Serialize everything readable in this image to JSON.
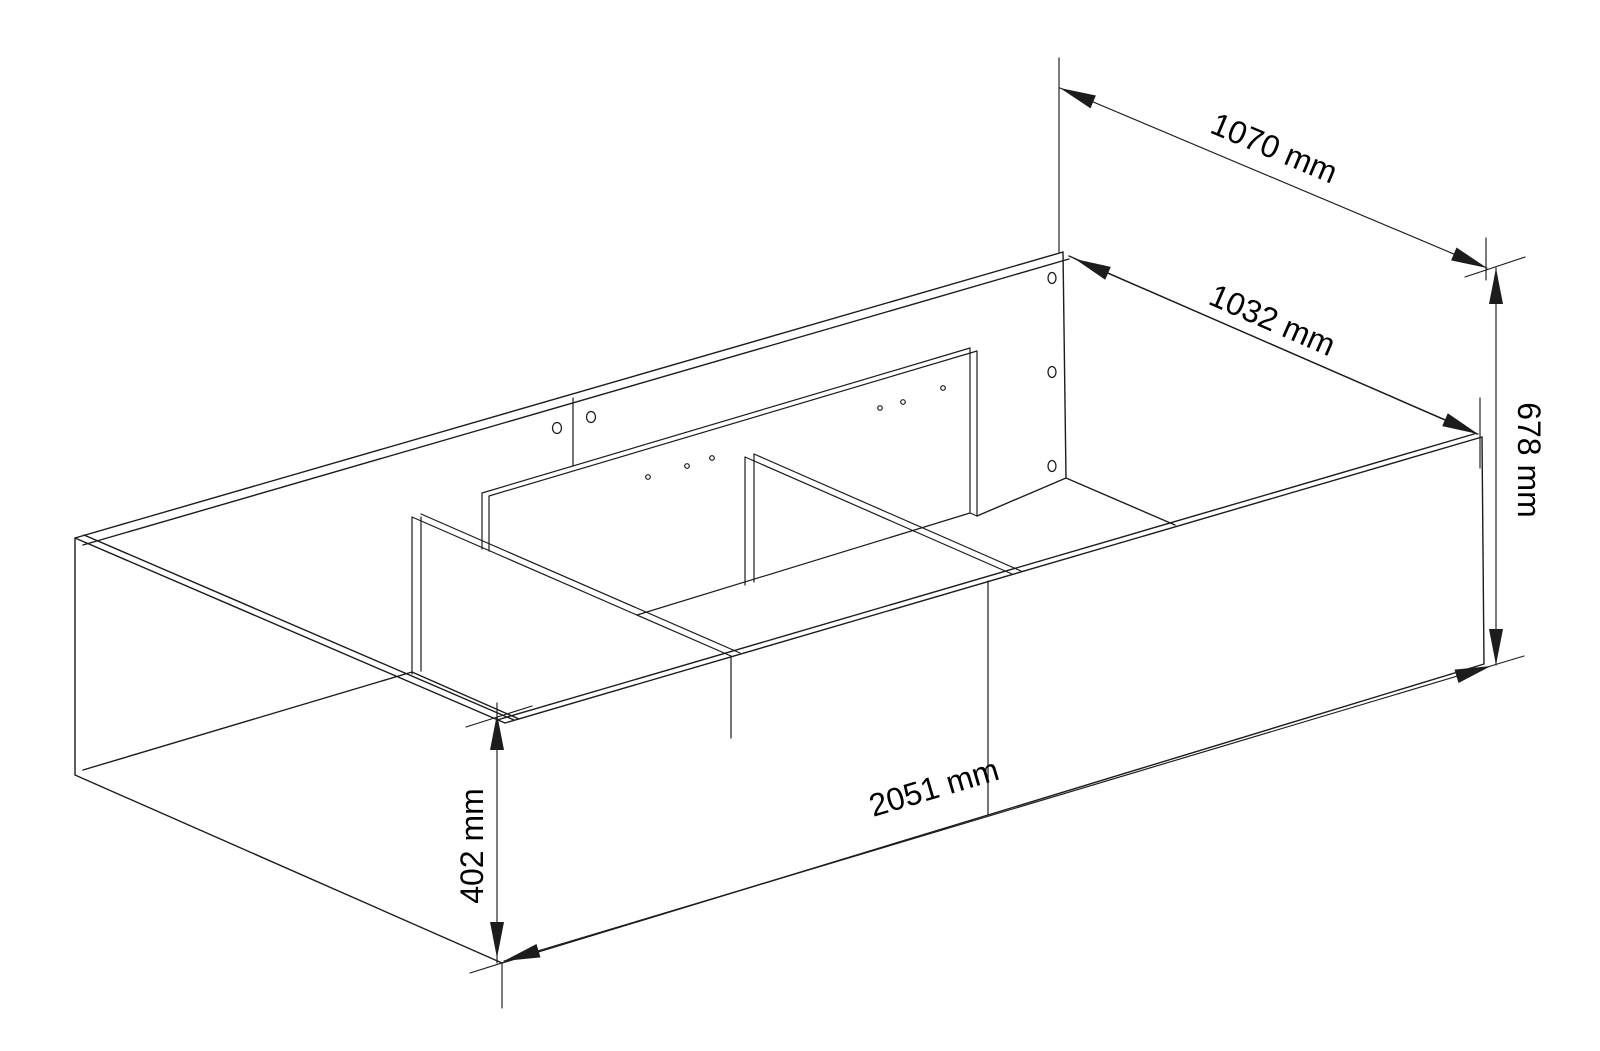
{
  "page": {
    "background": "#ffffff"
  },
  "diagram": {
    "type": "isometric-technical-drawing",
    "subject": "storage-bed-frame-box",
    "unit": "mm",
    "line_color": "#1c1c1c",
    "dimensions": [
      {
        "id": "depth-overall",
        "label": "1070 mm",
        "value": 1070,
        "placement": "top-right-diagonal"
      },
      {
        "id": "depth-inner",
        "label": "1032 mm",
        "value": 1032,
        "placement": "along-right-end-top-edge"
      },
      {
        "id": "height-back",
        "label": "678 mm",
        "value": 678,
        "placement": "right-vertical"
      },
      {
        "id": "length-overall",
        "label": "2051 mm",
        "value": 2051,
        "placement": "bottom-front-diagonal"
      },
      {
        "id": "height-front",
        "label": "402 mm",
        "value": 402,
        "placement": "left-vertical"
      }
    ],
    "features": {
      "back_panel_edge_holes": 3,
      "back_panel_joint_holes": 2,
      "panel_joint_lines": 2,
      "rail_pilot_holes": 6,
      "transverse_dividers": 2,
      "support_rails": 1
    }
  }
}
